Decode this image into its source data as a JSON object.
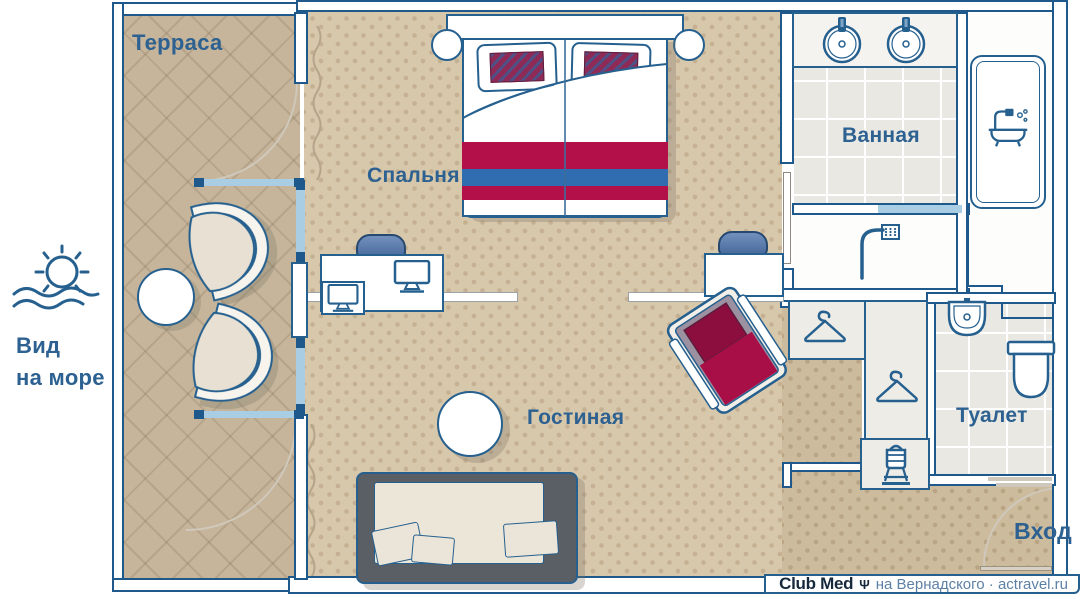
{
  "labels": {
    "terrace": "Терраса",
    "sea_view_line1": "Вид",
    "sea_view_line2": "на море",
    "bedroom": "Спальня",
    "bathroom": "Ванная",
    "living": "Гостиная",
    "toilet": "Туалет",
    "entrance": "Вход"
  },
  "footer": {
    "brand": "Club Med",
    "trident": "Ψ",
    "caption": "на Вернадского · actravel.ru"
  },
  "colors": {
    "accent_blue": "#26608f",
    "label_blue": "#2d6191",
    "crimson": "#b3104a",
    "stripe_blue": "#2f6cb0",
    "floor_tan": "#d7c7ab",
    "terrace_tan": "#c6b59a",
    "tile_gray": "#eae8e2",
    "glass_blue": "#a9cde2"
  },
  "icons": [
    "sun-over-sea",
    "sink",
    "bathtub",
    "shower",
    "hanger",
    "luggage-rack",
    "washbasin",
    "toilet",
    "monitor",
    "tv",
    "trident"
  ]
}
